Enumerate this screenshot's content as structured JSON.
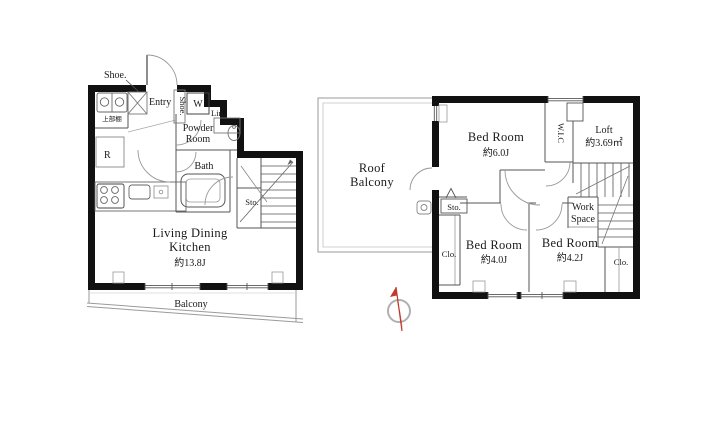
{
  "document": {
    "type": "floor-plan",
    "floors": 2
  },
  "colors": {
    "wall": "#111111",
    "partition_line": "#555555",
    "light_line": "#9a9a9a",
    "compass_needle": "#c0392b",
    "compass_ring": "#b0b0b0",
    "text": "#1a1a1a",
    "background": "#ffffff"
  },
  "icons": {
    "compass": "north-arrow",
    "stove": "four-burner-circles",
    "bathtub": "rounded-tub",
    "door": "quarter-arc-swing"
  },
  "floor1": {
    "labels": {
      "shoe_top": "Shoe.",
      "entry": "Entry",
      "shoe_side": "Shoe.",
      "washer": "W",
      "linen": "Lin.",
      "powder_line1": "Powder",
      "powder_line2": "Room",
      "bath": "Bath",
      "fridge": "R",
      "upper_shelf": "上部棚",
      "storage": "Sto.",
      "ldk_line1": "Living Dining",
      "ldk_line2": "Kitchen",
      "ldk_area": "約13.8J",
      "balcony": "Balcony"
    }
  },
  "floor2": {
    "labels": {
      "roof_line1": "Roof",
      "roof_line2": "Balcony",
      "bed6_name": "Bed Room",
      "bed6_area": "約6.0J",
      "wic": "W.I.C",
      "loft_name": "Loft",
      "loft_area": "約3.69㎡",
      "storage": "Sto.",
      "work_line1": "Work",
      "work_line2": "Space",
      "bed40_name": "Bed Room",
      "bed40_area": "約4.0J",
      "bed42_name": "Bed Room",
      "bed42_area": "約4.2J",
      "clo_left": "Clo.",
      "clo_right": "Clo."
    }
  }
}
